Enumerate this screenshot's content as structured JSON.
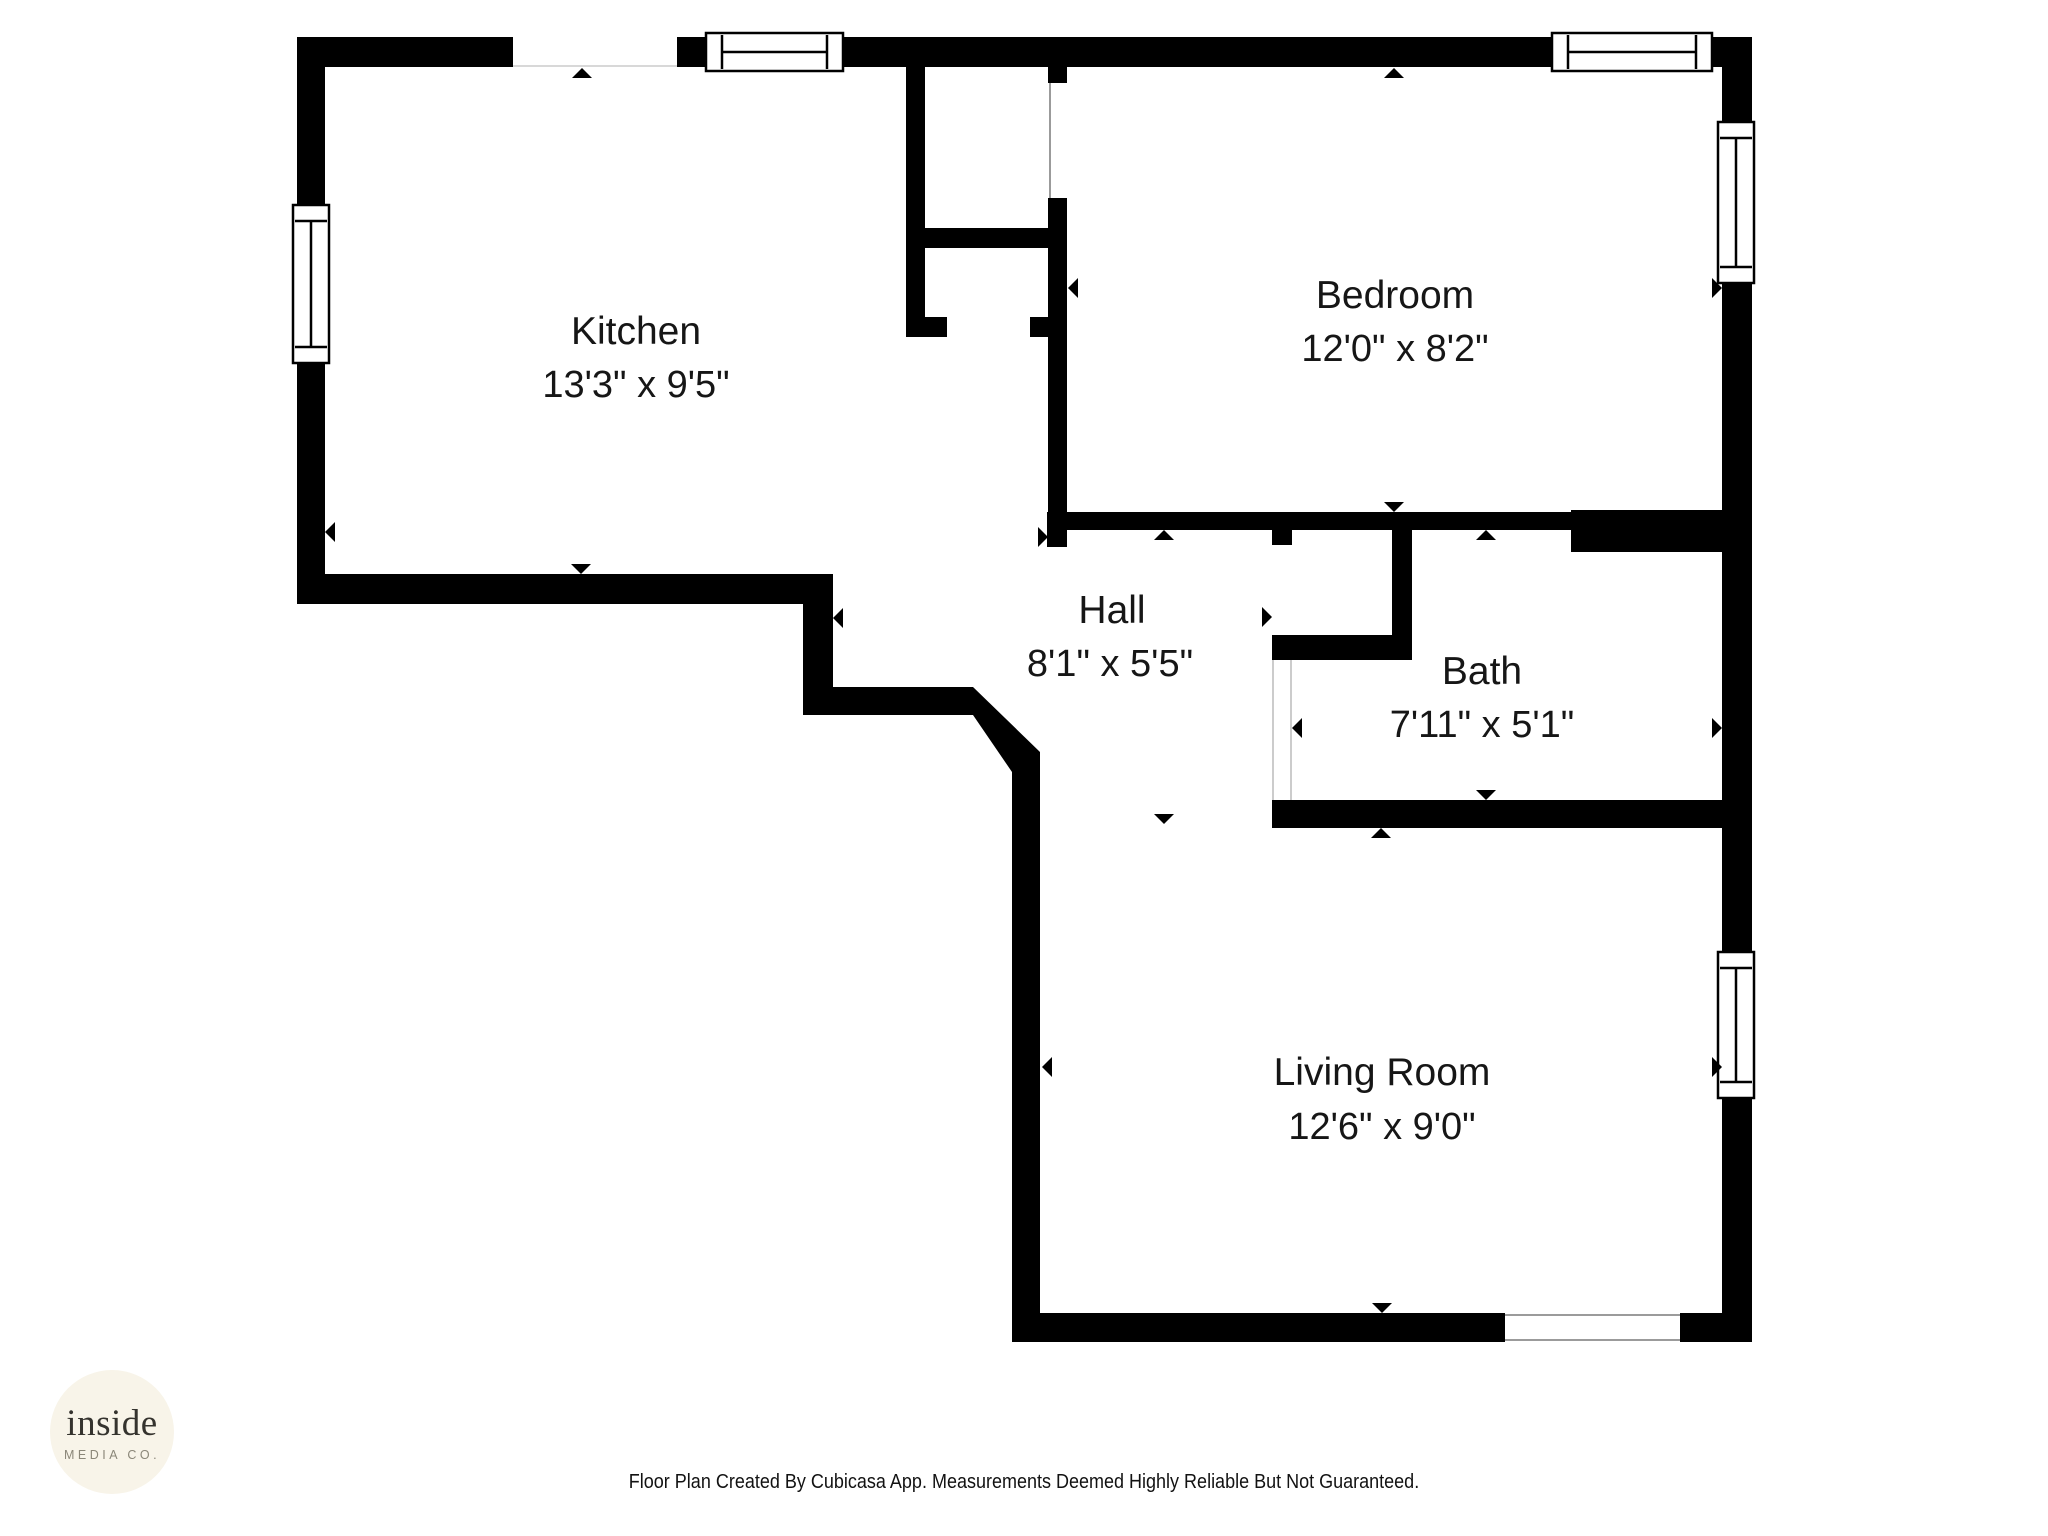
{
  "page": {
    "background_color": "#ffffff",
    "wall_color": "#000000",
    "marker_color": "#000000",
    "opening_outline_color": "#b9b9b9"
  },
  "floor_plan": {
    "rooms": [
      {
        "id": "kitchen",
        "name": "Kitchen",
        "dimensions": "13'3\" x 9'5\""
      },
      {
        "id": "bedroom",
        "name": "Bedroom",
        "dimensions": "12'0\" x 8'2\""
      },
      {
        "id": "hall",
        "name": "Hall",
        "dimensions": "8'1\" x 5'5\""
      },
      {
        "id": "bath",
        "name": "Bath",
        "dimensions": "7'11\" x 5'1\""
      },
      {
        "id": "living_room",
        "name": "Living Room",
        "dimensions": "12'6\" x 9'0\""
      }
    ]
  },
  "logo": {
    "name": "inside",
    "subtitle": "MEDIA CO.",
    "circle_color": "#f8f4e9",
    "name_color": "#35332e",
    "subtitle_color": "#8b8779"
  },
  "footer": {
    "disclaimer": "Floor Plan Created By Cubicasa App. Measurements Deemed Highly Reliable But Not Guaranteed."
  }
}
